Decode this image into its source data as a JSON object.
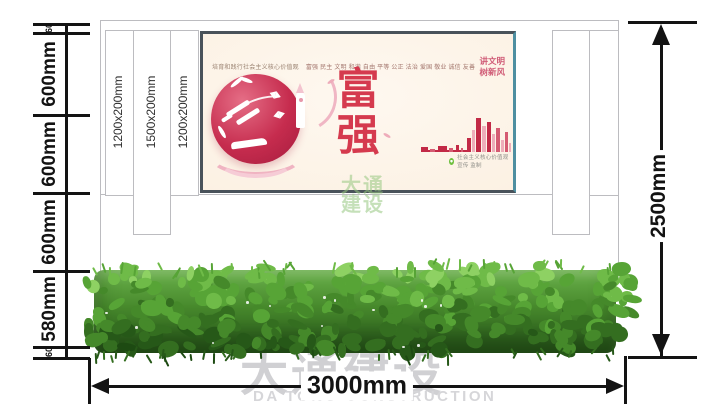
{
  "dims": {
    "left_chain": [
      "60",
      "600mm",
      "600mm",
      "600mm",
      "580mm",
      "60"
    ],
    "right_total": "2500mm",
    "bottom_total": "3000mm"
  },
  "columns": {
    "labels": [
      "1200x200mm",
      "1500x200mm",
      "1200x200mm"
    ]
  },
  "poster": {
    "header": "培育和践行社会主义核心价值观",
    "values": "富强 民主 文明 和谐 自由 平等 公正 法治 爱国 敬业 诚信 友善",
    "main_char_top": "富",
    "main_char_bottom": "强",
    "slogan_line1": "讲文明",
    "slogan_line2": "树新风",
    "credit": "社会主义核心价值观宣传 监制"
  },
  "watermarks": {
    "center_line1": "大通",
    "center_line2": "建设",
    "bottom_cn": "大通建设",
    "bottom_en": "DA TONG CONSTRUCTION"
  },
  "colors": {
    "dimension_line": "#131313",
    "wall_border": "#bcbcc0",
    "poster_bg": "#fdf3e7",
    "poster_frame": "#49525a",
    "accent_red": "#c9294a",
    "hedge_green": "#47892c",
    "watermark_gray": "#d0d0d3",
    "watermark_green": "#96c680"
  }
}
